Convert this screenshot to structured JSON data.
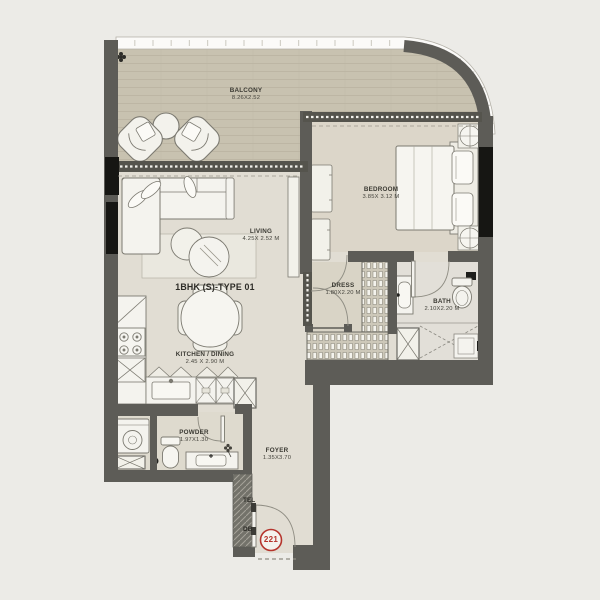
{
  "plan": {
    "title": "1BHK (S)-TYPE 01",
    "unit_number": "221",
    "rooms": {
      "balcony": {
        "name": "BALCONY",
        "dims": "8.26X2.52"
      },
      "living": {
        "name": "LIVING",
        "dims": "4.25X 2.52 M"
      },
      "bedroom": {
        "name": "BEDROOM",
        "dims": "3.85X 3.12 M"
      },
      "kitchen_dining": {
        "name": "KITCHEN / DINING",
        "dims": "2.45 X 2.90 M"
      },
      "dress": {
        "name": "DRESS",
        "dims": "1.80X2.20 M"
      },
      "bath": {
        "name": "BATH",
        "dims": "2.10X2.20 M"
      },
      "powder": {
        "name": "POWDER",
        "dims": "1.97X1.30"
      },
      "foyer": {
        "name": "FOYER",
        "dims": "1.35X3.70"
      }
    },
    "annotations": {
      "tel": "TEL",
      "db": "DB"
    },
    "colors": {
      "wall": "#5d5c57",
      "window_band": "#55544d",
      "floor": "#e1ddd3",
      "bedroom_floor": "#dcd6c9",
      "balcony_floor": "#c8c2b0",
      "furniture": "#f4f3ee",
      "accent_red": "#b5342c",
      "background": "#ecebe7"
    }
  }
}
